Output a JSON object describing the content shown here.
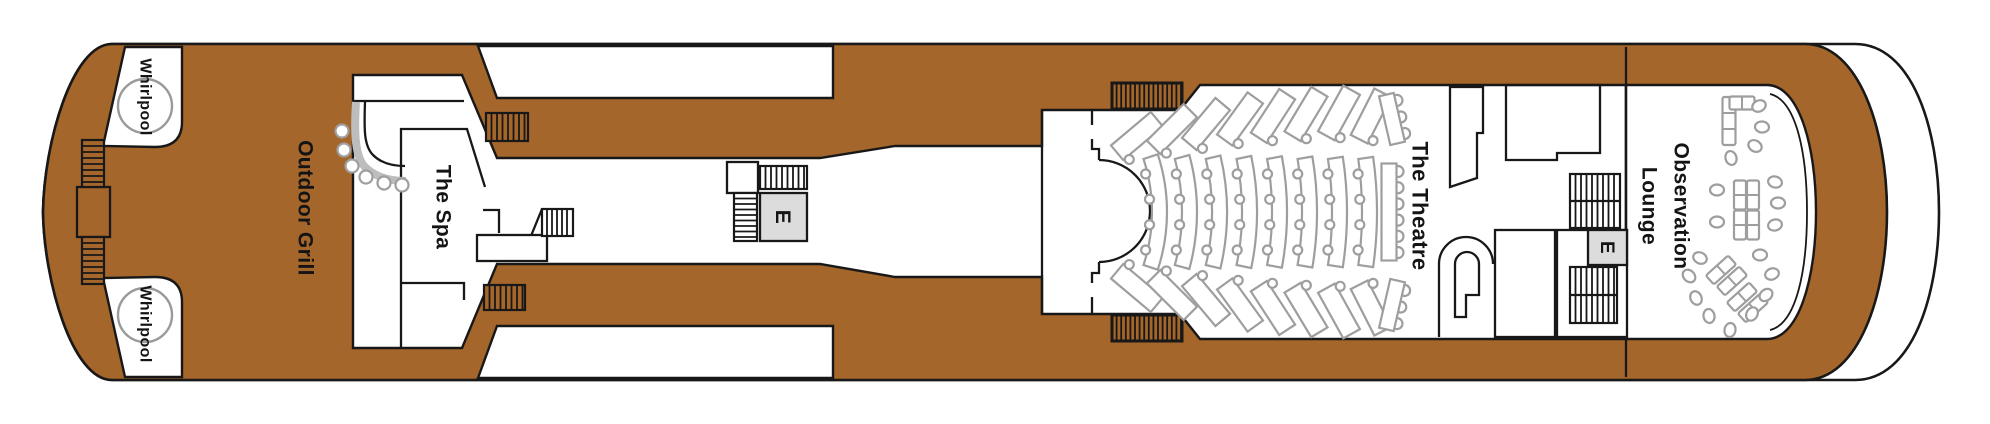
{
  "labels": {
    "whirlpool_top": "Whirlpool",
    "whirlpool_bottom": "Whirlpool",
    "outdoor_grill": "Outdoor Grill",
    "spa": "The Spa",
    "theatre": "The Theatre",
    "observation_line1": "Observation",
    "observation_line2": "Lounge",
    "elevator": "E"
  },
  "colors": {
    "deck_brown": "#a4662a",
    "outline": "#181818",
    "furniture_gray": "#9e9e9e",
    "elevator_fill": "#dcdcdc",
    "room_white": "#ffffff"
  },
  "plan": {
    "whirlpools": [
      {
        "cx": 145,
        "cy": 106,
        "r": 27
      },
      {
        "cx": 145,
        "cy": 315,
        "r": 27
      }
    ],
    "boxes": [
      {
        "x": 77,
        "y": 187,
        "w": 33,
        "h": 50,
        "fill": "deck"
      },
      {
        "x": 727,
        "y": 162,
        "w": 31,
        "h": 31,
        "fill": "white"
      },
      {
        "x": 477,
        "y": 235,
        "w": 70,
        "h": 26,
        "fill": "white"
      },
      {
        "x": 1495,
        "y": 230,
        "w": 60,
        "h": 107,
        "fill": "white"
      },
      {
        "x": 1557,
        "y": 230,
        "w": 70,
        "h": 107,
        "fill": "white"
      }
    ],
    "stairs": [
      {
        "x": 82,
        "y": 140,
        "w": 22,
        "h": 47,
        "dir": "h",
        "fill": "deck",
        "step": 6
      },
      {
        "x": 82,
        "y": 237,
        "w": 22,
        "h": 47,
        "dir": "h",
        "fill": "deck",
        "step": 6
      },
      {
        "x": 486,
        "y": 113,
        "w": 42,
        "h": 28,
        "dir": "v",
        "fill": "deck",
        "step": 5.5
      },
      {
        "x": 484,
        "y": 285,
        "w": 41,
        "h": 25,
        "dir": "v",
        "fill": "deck",
        "step": 5.5
      },
      {
        "x": 760,
        "y": 166,
        "w": 47,
        "h": 23,
        "dir": "v",
        "fill": "white",
        "step": 5.5
      },
      {
        "x": 734,
        "y": 193,
        "w": 23,
        "h": 48,
        "dir": "h",
        "fill": "white",
        "step": 5.5
      },
      {
        "x": 542,
        "y": 209,
        "w": 31,
        "h": 27,
        "dir": "v",
        "fill": "white",
        "step": 5
      },
      {
        "x": 1112,
        "y": 83,
        "w": 70,
        "h": 26,
        "dir": "v",
        "fill": "deck",
        "step": 4.6,
        "thick": true
      },
      {
        "x": 1112,
        "y": 315,
        "w": 70,
        "h": 26,
        "dir": "v",
        "fill": "deck",
        "step": 4.6,
        "thick": true
      },
      {
        "x": 1570,
        "y": 174,
        "w": 50,
        "h": 54,
        "dir": "v",
        "fill": "white",
        "step": 5.5,
        "divider": true
      },
      {
        "x": 1570,
        "y": 267,
        "w": 47,
        "h": 56,
        "dir": "v",
        "fill": "white",
        "step": 5.5,
        "divider": true
      }
    ],
    "elevators": [
      {
        "x": 760,
        "y": 193,
        "w": 47,
        "h": 48,
        "fs": 21
      },
      {
        "x": 1588,
        "y": 230,
        "w": 39,
        "h": 35,
        "fs": 19
      }
    ],
    "theatre": {
      "banks": [
        {
          "dotSide": 1,
          "benches": [
            [
              1137,
              136,
              -40
            ],
            [
              1172,
              129,
              -45
            ],
            [
              1206,
              124,
              -50
            ],
            [
              1240,
              119,
              -54
            ],
            [
              1273,
              116,
              -57
            ],
            [
              1306,
              114,
              -59
            ],
            [
              1339,
              113,
              -61
            ],
            [
              1371,
              116,
              -63
            ]
          ]
        },
        {
          "dotSide": -1,
          "benches": [
            [
              1137,
              288,
              40
            ],
            [
              1172,
              295,
              45
            ],
            [
              1206,
              300,
              50
            ],
            [
              1240,
              305,
              54
            ],
            [
              1273,
              308,
              57
            ],
            [
              1306,
              310,
              59
            ],
            [
              1339,
              311,
              61
            ],
            [
              1371,
              308,
              63
            ]
          ]
        }
      ],
      "arc_rows": [
        1152,
        1182,
        1212,
        1242,
        1272,
        1302,
        1332,
        1362
      ],
      "arc_center": {
        "cx": 982,
        "cy": 212,
        "half_span": 53,
        "band": 15
      },
      "back_rows": [
        [
          1392,
          119,
          -13,
          50
        ],
        [
          1389,
          212,
          0,
          97
        ],
        [
          1392,
          305,
          13,
          50
        ]
      ]
    },
    "lounge": {
      "sofas": [
        {
          "x": 1729,
          "y": 121,
          "w": 13,
          "h": 48,
          "a": 0
        },
        {
          "x": 1742,
          "y": 103,
          "w": 25,
          "h": 13,
          "a": 0
        },
        {
          "x": 1740,
          "y": 195,
          "w": 12,
          "h": 29,
          "a": 0
        },
        {
          "x": 1753,
          "y": 195,
          "w": 12,
          "h": 29,
          "a": 0
        },
        {
          "x": 1740,
          "y": 225,
          "w": 12,
          "h": 29,
          "a": 0
        },
        {
          "x": 1753,
          "y": 225,
          "w": 12,
          "h": 29,
          "a": 0
        },
        {
          "x": 1721,
          "y": 270,
          "w": 12,
          "h": 30,
          "a": 48
        },
        {
          "x": 1732,
          "y": 281,
          "w": 12,
          "h": 30,
          "a": 48
        },
        {
          "x": 1742,
          "y": 297,
          "w": 12,
          "h": 30,
          "a": 48
        },
        {
          "x": 1753,
          "y": 308,
          "w": 12,
          "h": 30,
          "a": 48
        }
      ],
      "chairs": [
        {
          "x": 1759,
          "y": 106,
          "a": -25
        },
        {
          "x": 1762,
          "y": 127,
          "a": 5
        },
        {
          "x": 1755,
          "y": 146,
          "a": 30
        },
        {
          "x": 1731,
          "y": 158,
          "a": 75
        },
        {
          "x": 1717,
          "y": 190,
          "a": 0
        },
        {
          "x": 1717,
          "y": 222,
          "a": 0
        },
        {
          "x": 1775,
          "y": 182,
          "a": 15
        },
        {
          "x": 1778,
          "y": 203,
          "a": 0
        },
        {
          "x": 1775,
          "y": 225,
          "a": -15
        },
        {
          "x": 1700,
          "y": 258,
          "a": 25
        },
        {
          "x": 1689,
          "y": 276,
          "a": 45
        },
        {
          "x": 1696,
          "y": 298,
          "a": 65
        },
        {
          "x": 1709,
          "y": 316,
          "a": 80
        },
        {
          "x": 1760,
          "y": 255,
          "a": 0
        },
        {
          "x": 1772,
          "y": 274,
          "a": -20
        },
        {
          "x": 1766,
          "y": 295,
          "a": -40
        },
        {
          "x": 1752,
          "y": 314,
          "a": -60
        },
        {
          "x": 1730,
          "y": 330,
          "a": -80
        }
      ]
    },
    "bar_stools": [
      {
        "cx": 342,
        "cy": 131
      },
      {
        "cx": 344,
        "cy": 150
      },
      {
        "cx": 352,
        "cy": 166
      },
      {
        "cx": 366,
        "cy": 177
      },
      {
        "cx": 384,
        "cy": 183
      },
      {
        "cx": 402,
        "cy": 185
      }
    ]
  }
}
